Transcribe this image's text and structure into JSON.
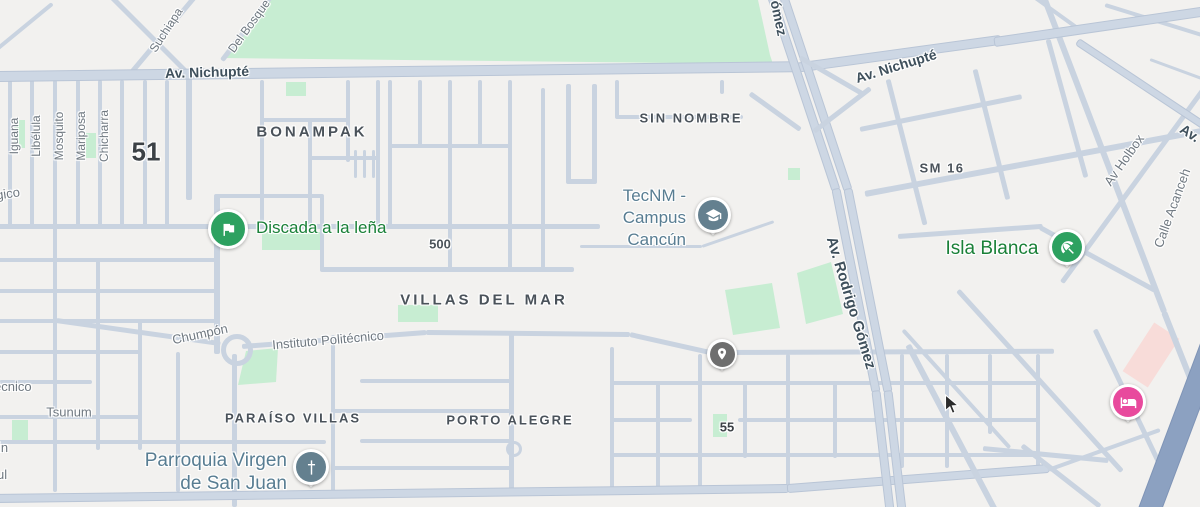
{
  "colors": {
    "background": "#f2f1ef",
    "road": "#c9d3e0",
    "major_road": "#cdd7e4",
    "highway": "#8ca1c1",
    "park": "#c7edd2",
    "building_highlight": "#f8dcd9",
    "street_label": "#6f7880",
    "road_label": "#3f505c",
    "area_label": "#4a525a",
    "poi_green": "#1a8038",
    "poi_green_icon": "#2da160",
    "poi_slate": "#587d92",
    "poi_slate_icon": "#64808f",
    "poi_pink_icon": "#e84a9d",
    "poi_gray_icon": "#6e6e6e"
  },
  "areas": {
    "bonampak": "BONAMPAK",
    "sin_nombre": "SIN NOMBRE",
    "villas_del_mar": "VILLAS DEL MAR",
    "sm16": "SM 16",
    "paraiso_villas": "PARAÍSO VILLAS",
    "porto_alegre": "PORTO ALEGRE"
  },
  "roads": {
    "nichupte_left": "Av. Nichupté",
    "nichupte_right": "Av. Nichupté",
    "rodrigo_gomez": "Av. Rodrigo Gómez",
    "gomez_partial": "ómez",
    "av_partial": "Av."
  },
  "streets": {
    "suchiapa": "Suchiapa",
    "del_bosque": "Del Bosque",
    "iguana": "Iguana",
    "libelula": "Libélula",
    "mosquito": "Mosquito",
    "mariposa": "Mariposa",
    "chicharra": "Chicharra",
    "gico_partial": "gico",
    "chumpon": "Chumpón",
    "instituto_politecnico": "Instituto Politécnico",
    "ecnico_partial": "écnico",
    "tsunum": "Tsunum",
    "in_partial": "in",
    "ul_partial": "ul",
    "av_holbox": "Av Holbox",
    "calle_acanceh": "Calle Acanceh"
  },
  "numbers": {
    "n51": "51",
    "n500": "500",
    "n55": "55"
  },
  "pois": {
    "discada": {
      "label": "Discada a la leña"
    },
    "tecnm": {
      "line1": "TecNM -",
      "line2": "Campus",
      "line3": "Cancún"
    },
    "isla_blanca": {
      "label": "Isla Blanca"
    },
    "parroquia": {
      "line1": "Parroquia Virgen",
      "line2": "de San Juan"
    }
  }
}
